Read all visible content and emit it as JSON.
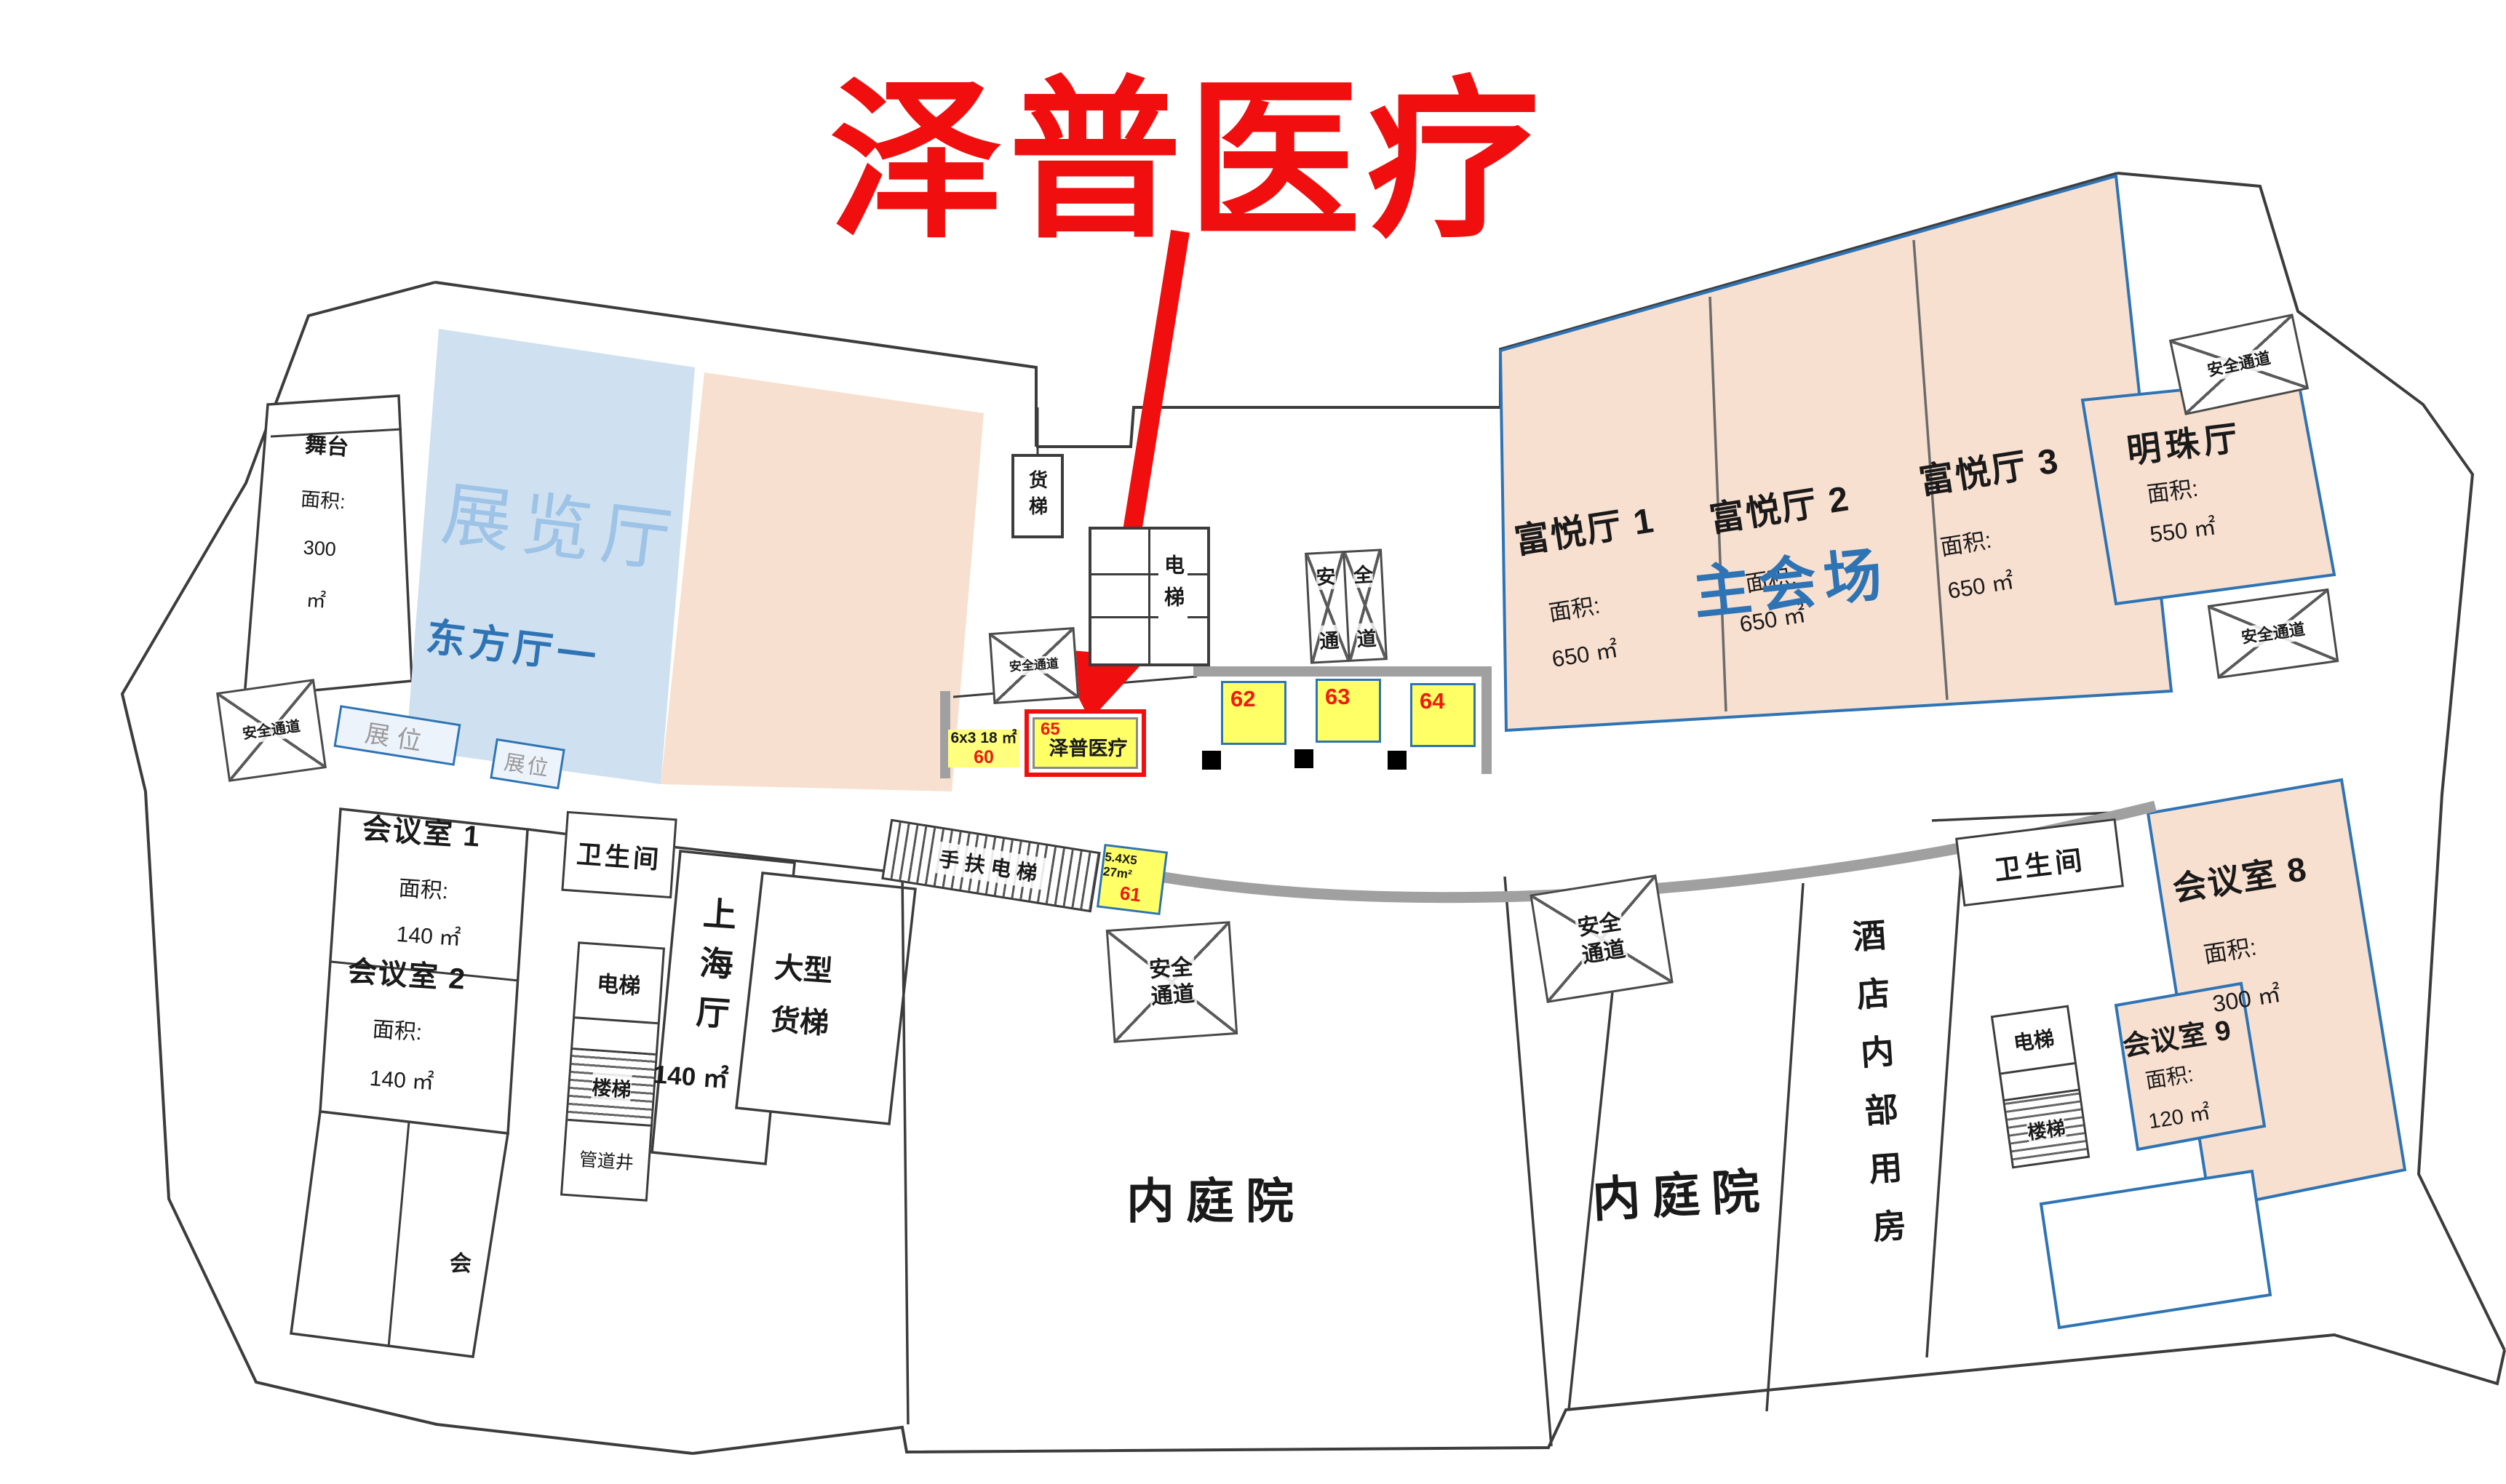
{
  "annotation": {
    "title": "泽普医疗",
    "title_color": "#f10e0e",
    "highlight_booth_id": "65"
  },
  "labels": {
    "safety_passage": "安全通道",
    "safety_line1": "安全",
    "safety_line2": "通道",
    "safety_char_1": "安",
    "safety_char_2": "全",
    "safety_char_3": "通",
    "safety_char_4": "道",
    "restroom": "卫生间",
    "elevator": "电梯",
    "stairs": "楼梯",
    "freight_elevator": "货梯",
    "large_freight_line1": "大型",
    "large_freight_line2": "货梯",
    "escalator": "手扶电梯",
    "pipe_shaft": "管道井",
    "courtyard": "内庭院",
    "hotel_internal_rooms": "酒店内部用房",
    "booth_slot": "展位",
    "area_label": "面积:",
    "partial_room_char": "会"
  },
  "halls": {
    "stage": {
      "name": "舞台",
      "area_value": "300",
      "area_unit": "㎡"
    },
    "exhibition": {
      "name": "展览厅"
    },
    "oriental": {
      "name": "东方厅一"
    },
    "fuyue_1": {
      "name": "富悦厅 1",
      "area": "650 ㎡"
    },
    "fuyue_2": {
      "name": "富悦厅 2",
      "area": "650 ㎡"
    },
    "fuyue_3": {
      "name": "富悦厅 3",
      "area": "650 ㎡"
    },
    "main_venue": {
      "name": "主会场"
    },
    "mingzhu": {
      "name": "明珠厅",
      "area": "550 ㎡"
    },
    "shanghai": {
      "name": "上海厅",
      "area": "140 ㎡"
    },
    "meeting_1": {
      "name": "会议室 1",
      "area": "140 ㎡"
    },
    "meeting_2": {
      "name": "会议室 2",
      "area": "140 ㎡"
    },
    "meeting_8": {
      "name": "会议室 8",
      "area": "300 ㎡"
    },
    "meeting_9": {
      "name": "会议室 9",
      "area": "120 ㎡"
    }
  },
  "booths": {
    "b60": {
      "id": "60",
      "size": "6x3 18 ㎡"
    },
    "b61": {
      "id": "61",
      "size": "5.4X5 27m²"
    },
    "b62": {
      "id": "62"
    },
    "b63": {
      "id": "63"
    },
    "b64": {
      "id": "64"
    },
    "b65": {
      "id": "65",
      "company": "泽普医疗"
    }
  },
  "colors": {
    "accent_red": "#f10e0e",
    "booth_yellow": "#ffff66",
    "hall_peach": "#f8e0d0",
    "exhibition_blue": "#cfe0f0",
    "border_blue": "#2e74b5",
    "corridor_gray": "#a0a0a0",
    "wall": "#3c3c3c"
  }
}
